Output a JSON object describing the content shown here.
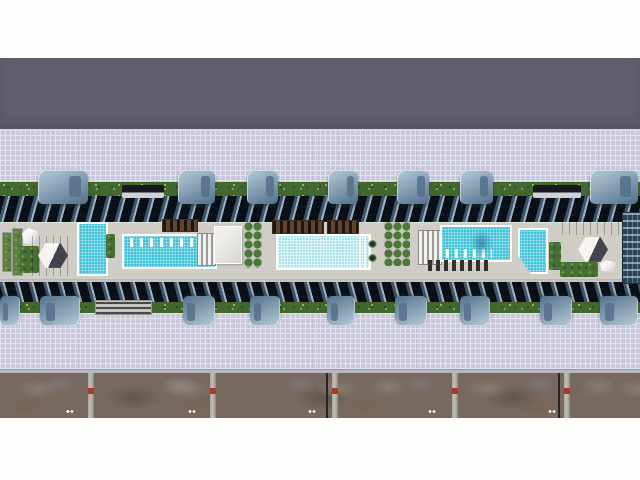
{
  "meta": {
    "description": "Top-down aerial 3D architectural rendering of a long residential condominium complex: two parallel rows of towers flanking a central rooftop amenity deck with three swimming pools, pergolas, cabanas, planters and palm trees; tiled plazas above and below, a dark roadway band at top and a weathered service strip with divider posts at bottom",
    "render_width": 640,
    "render_height": 480
  },
  "palette": {
    "white": "#fdfdfc",
    "road_dark": "#5f5d6e",
    "plaza": "#c9c9db",
    "plaza_line": "#e2e2ef",
    "hedge": "#41682f",
    "hedge_light": "#8fbc55",
    "flower_yellow": "#e4d24b",
    "facade_dark": "#1b2530",
    "facade_mid": "#3d5568",
    "facade_light": "#9db2c2",
    "deck": "#d0cdc7",
    "pool_water": "#3fc3d8",
    "pool_water_light": "#a9e2ec",
    "pool_rim": "#ffffff",
    "pergola_brown": "#5c4632",
    "tower_light": "#a9becd",
    "tower_mid": "#7b95ab",
    "tower_dark": "#54718a",
    "canopy_black": "#17191d",
    "navy_tower": "#2c4257",
    "ground": "#77695f",
    "post": "#c4c0ba",
    "post_red": "#a33c28",
    "curb": "#b7b7c6"
  },
  "scene": {
    "bands": [
      {
        "name": "sky-top",
        "kind": "white",
        "y": 0,
        "h": 58
      },
      {
        "name": "upper-road",
        "kind": "dark",
        "y": 58,
        "h": 71
      },
      {
        "name": "upper-plaza",
        "kind": "plaza",
        "y": 131,
        "h": 65
      },
      {
        "name": "upper-hedge",
        "kind": "hedge",
        "y": 182,
        "h": 14
      },
      {
        "name": "upper-facade",
        "kind": "facade-top",
        "y": 196,
        "h": 26
      },
      {
        "name": "pool-deck",
        "kind": "deck",
        "y": 222,
        "h": 58
      },
      {
        "name": "lower-facade",
        "kind": "facade-bottom",
        "y": 280,
        "h": 22
      },
      {
        "name": "lower-hedge",
        "kind": "hedge",
        "y": 302,
        "h": 11
      },
      {
        "name": "lower-plaza",
        "kind": "plaza",
        "y": 313,
        "h": 56
      },
      {
        "name": "curb-strip",
        "kind": "curb",
        "y": 369,
        "h": 4
      },
      {
        "name": "service-strip",
        "kind": "ground",
        "y": 373,
        "h": 45
      },
      {
        "name": "sky-bottom",
        "kind": "white",
        "y": 418,
        "h": 62
      }
    ],
    "top_towers": [
      {
        "x": 38,
        "w": 50
      },
      {
        "x": 178,
        "w": 37
      },
      {
        "x": 247,
        "w": 31
      },
      {
        "x": 328,
        "w": 30
      },
      {
        "x": 397,
        "w": 32
      },
      {
        "x": 460,
        "w": 33
      },
      {
        "x": 590,
        "w": 48
      }
    ],
    "top_tower_y": 170,
    "top_tower_h": 34,
    "top_canopies": [
      {
        "x": 122,
        "w": 42
      },
      {
        "x": 533,
        "w": 48
      }
    ],
    "canopy_y": 185,
    "canopy_h": 13,
    "bottom_towers": [
      {
        "x": 0,
        "w": 20
      },
      {
        "x": 40,
        "w": 40
      },
      {
        "x": 183,
        "w": 32
      },
      {
        "x": 250,
        "w": 30
      },
      {
        "x": 327,
        "w": 28
      },
      {
        "x": 395,
        "w": 32
      },
      {
        "x": 460,
        "w": 30
      },
      {
        "x": 540,
        "w": 32
      },
      {
        "x": 600,
        "w": 38
      }
    ],
    "bottom_tower_y": 296,
    "bottom_tower_h": 30,
    "deck_features": [
      {
        "name": "left-planter-box-a",
        "kind": "planter",
        "x": 2,
        "y": 232,
        "w": 8,
        "h": 38
      },
      {
        "name": "left-planter-box-b",
        "kind": "planter",
        "x": 12,
        "y": 228,
        "w": 9,
        "h": 46
      },
      {
        "name": "left-white-sculpture",
        "kind": "sculpture",
        "x": 22,
        "y": 228,
        "w": 16,
        "h": 17
      },
      {
        "name": "left-garden",
        "kind": "greenery",
        "x": 20,
        "y": 246,
        "w": 19,
        "h": 27
      },
      {
        "name": "left-cabana-wood-deck",
        "kind": "wood",
        "x": 32,
        "y": 236,
        "w": 42,
        "h": 40
      },
      {
        "name": "left-hex-cabana",
        "kind": "hex",
        "x": 38,
        "y": 242,
        "w": 30,
        "h": 27
      },
      {
        "name": "left-vertical-pool",
        "kind": "pool",
        "x": 77,
        "y": 222,
        "w": 27,
        "h": 50
      },
      {
        "name": "left-small-garden",
        "kind": "greenery",
        "x": 106,
        "y": 234,
        "w": 9,
        "h": 24
      },
      {
        "name": "left-lap-pool",
        "kind": "pool",
        "x": 122,
        "y": 234,
        "w": 91,
        "h": 31,
        "extras": [
          "loungers-top"
        ]
      },
      {
        "name": "left-pergola",
        "kind": "pergola",
        "x": 162,
        "y": 219,
        "w": 34,
        "h": 11
      },
      {
        "name": "pool-bridge-slats",
        "kind": "slats",
        "x": 197,
        "y": 233,
        "w": 17,
        "h": 31
      },
      {
        "name": "white-pavilion",
        "kind": "white",
        "x": 214,
        "y": 226,
        "w": 26,
        "h": 36
      },
      {
        "name": "planter-grid-a",
        "kind": "grid",
        "x": 244,
        "y": 222,
        "w": 18,
        "h": 46
      },
      {
        "name": "center-pergola-1",
        "kind": "pergola",
        "x": 272,
        "y": 220,
        "w": 50,
        "h": 12
      },
      {
        "name": "center-pergola-2",
        "kind": "pergola",
        "x": 327,
        "y": 220,
        "w": 30,
        "h": 12
      },
      {
        "name": "center-main-pool",
        "kind": "pool-light",
        "x": 276,
        "y": 234,
        "w": 91,
        "h": 32,
        "extras": [
          "steps-right"
        ]
      },
      {
        "name": "palm-tree-1",
        "kind": "palm",
        "x": 366,
        "y": 238,
        "w": 13,
        "h": 12
      },
      {
        "name": "palm-tree-2",
        "kind": "palm",
        "x": 366,
        "y": 252,
        "w": 13,
        "h": 12
      },
      {
        "name": "planter-grid-b",
        "kind": "grid",
        "x": 384,
        "y": 222,
        "w": 26,
        "h": 44
      },
      {
        "name": "cabana-row-slats",
        "kind": "slats",
        "x": 418,
        "y": 230,
        "w": 22,
        "h": 33
      },
      {
        "name": "right-lounger-pool",
        "kind": "pool",
        "x": 440,
        "y": 225,
        "w": 68,
        "h": 33,
        "extras": [
          "loungers-bottom",
          "palm-shadow"
        ]
      },
      {
        "name": "right-deck-loungers",
        "kind": "loungers",
        "x": 428,
        "y": 260,
        "w": 62,
        "h": 11
      },
      {
        "name": "right-corner-pool",
        "kind": "pool-diag",
        "x": 518,
        "y": 228,
        "w": 30,
        "h": 46
      },
      {
        "name": "right-garden-a",
        "kind": "greenery",
        "x": 549,
        "y": 242,
        "w": 12,
        "h": 28
      },
      {
        "name": "right-wood-lounge",
        "kind": "wood",
        "x": 562,
        "y": 218,
        "w": 64,
        "h": 17
      },
      {
        "name": "right-hex-cabana",
        "kind": "hex",
        "x": 578,
        "y": 236,
        "w": 30,
        "h": 27
      },
      {
        "name": "right-garden-b",
        "kind": "greenery",
        "x": 560,
        "y": 262,
        "w": 38,
        "h": 15
      },
      {
        "name": "right-white-seat",
        "kind": "sculpture",
        "x": 600,
        "y": 260,
        "w": 16,
        "h": 12
      },
      {
        "name": "right-navy-tower-roof",
        "kind": "navy",
        "x": 622,
        "y": 212,
        "w": 18,
        "h": 70
      },
      {
        "name": "lower-bridge-walkway",
        "kind": "walkway",
        "x": 95,
        "y": 300,
        "w": 55,
        "h": 13
      }
    ],
    "ground": {
      "posts_x": [
        88,
        210,
        332,
        452,
        564
      ],
      "post_w": 6,
      "seams_x": [
        326,
        558
      ],
      "speck_pairs_x": [
        66,
        188,
        308,
        428,
        548
      ],
      "speck_y": 410
    }
  }
}
